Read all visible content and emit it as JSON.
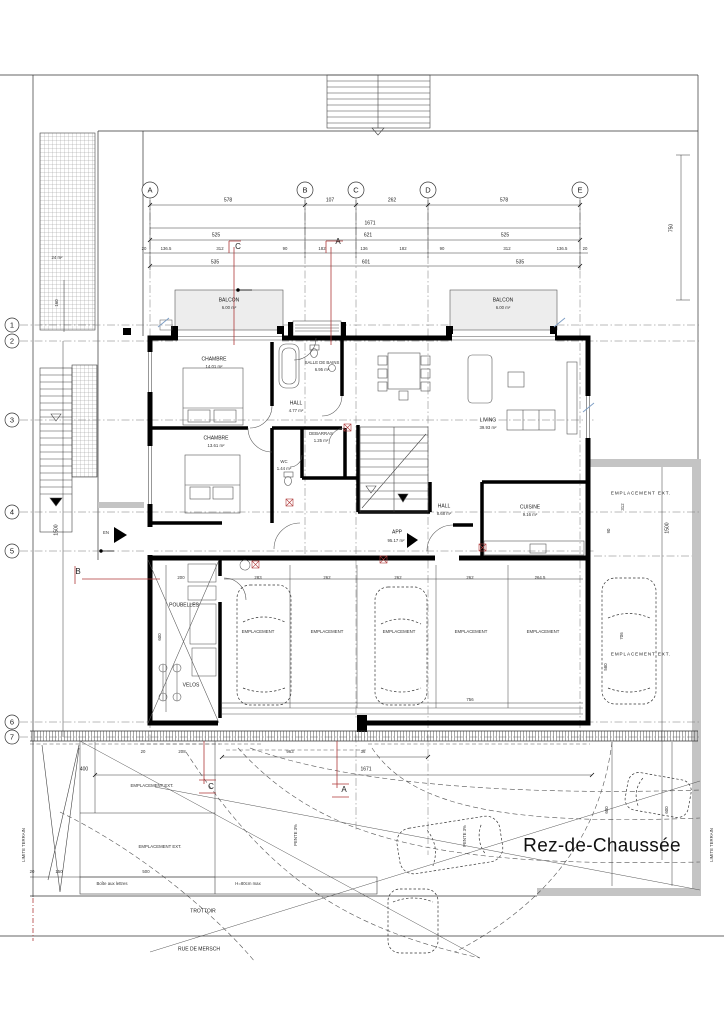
{
  "title": "Rez-de-Chaussée",
  "colors": {
    "wall": "#000000",
    "gray_wall": "#c4c4c4",
    "balcony_fill": "#ededed",
    "section_marker": "#b03a3a"
  },
  "grid": {
    "cols": [
      "A",
      "B",
      "C",
      "D",
      "E"
    ],
    "rows": [
      "1",
      "2",
      "3",
      "4",
      "5",
      "6",
      "7"
    ]
  },
  "sections": {
    "a": "A",
    "b": "B",
    "c": "C"
  },
  "rooms": {
    "balcon1": {
      "name": "BALCON",
      "area": "6.00 m²"
    },
    "balcon2": {
      "name": "BALCON",
      "area": "6.00 m²"
    },
    "chambre1": {
      "name": "CHAMBRE",
      "area": "14.01 m²"
    },
    "salle_de_bains": {
      "name": "SALLE DE BAINS",
      "area": "6.95 m²"
    },
    "hall": {
      "name": "HALL",
      "area": "4.77 m²"
    },
    "chambre2": {
      "name": "CHAMBRE",
      "area": "13.61 m²"
    },
    "debarras": {
      "name": "DEBARRAS",
      "area": "1.25 m²"
    },
    "wc": {
      "name": "WC",
      "area": "1.44 m²"
    },
    "living": {
      "name": "LIVING",
      "area": "39.93 m²"
    },
    "cuisine": {
      "name": "CUISINE",
      "area": "9.16 m²"
    },
    "hall2": {
      "name": "HALL",
      "area": "8.68 m²"
    },
    "app": {
      "name": "APP",
      "area": "95.17 m²"
    },
    "poubelles": {
      "name": "POUBELLES"
    },
    "velos": {
      "name": "VELOS"
    },
    "terrasse": {
      "area": "24 m²"
    }
  },
  "parking": {
    "space_label": "EMPLACEMENT",
    "ext_label": "EMPLACEMENT EXT.",
    "bay_widths": [
      "283",
      "262",
      "262",
      "262",
      "264.5"
    ],
    "bay_total": "756"
  },
  "site": {
    "entrance": "EN",
    "trottoir": "TROTTOIR",
    "street": "RUE DE MERSCH",
    "limite_terrain": "LIMITE TERRAIN",
    "mailbox": "Boîte aux lettres",
    "height_note": "H=80cm max",
    "slope": "PENTE 3%"
  },
  "dims": {
    "span_ab": "578",
    "span_bc": "107",
    "span_cd": "262",
    "span_de": "578",
    "total_width": "1671",
    "front_left": "525",
    "front_mid": "621",
    "front_right": "525",
    "chain": [
      "20",
      "136.5",
      "312",
      "90",
      "182",
      "136",
      "182",
      "90",
      "312",
      "136.5",
      "20"
    ],
    "sub_left": "535",
    "sub_mid": "601",
    "sub_right": "535",
    "right_750": "750",
    "left_160": "160",
    "left_1500": "1500",
    "right_1500": "1500",
    "poubelles_600": "600",
    "poubelles_200": "200",
    "ext_312": "312",
    "ext_90": "90",
    "ext_580": "580",
    "ext_706": "706",
    "bottom_400": "400",
    "bottom_963": "963",
    "bottom_20": "20",
    "bottom_208": "208",
    "bottom_36": "36",
    "bottom_total": "1671",
    "bottom_500": "500",
    "bottom_left_20": "20",
    "bottom_left_150": "150",
    "right_600a": "600",
    "right_600b": "600"
  }
}
